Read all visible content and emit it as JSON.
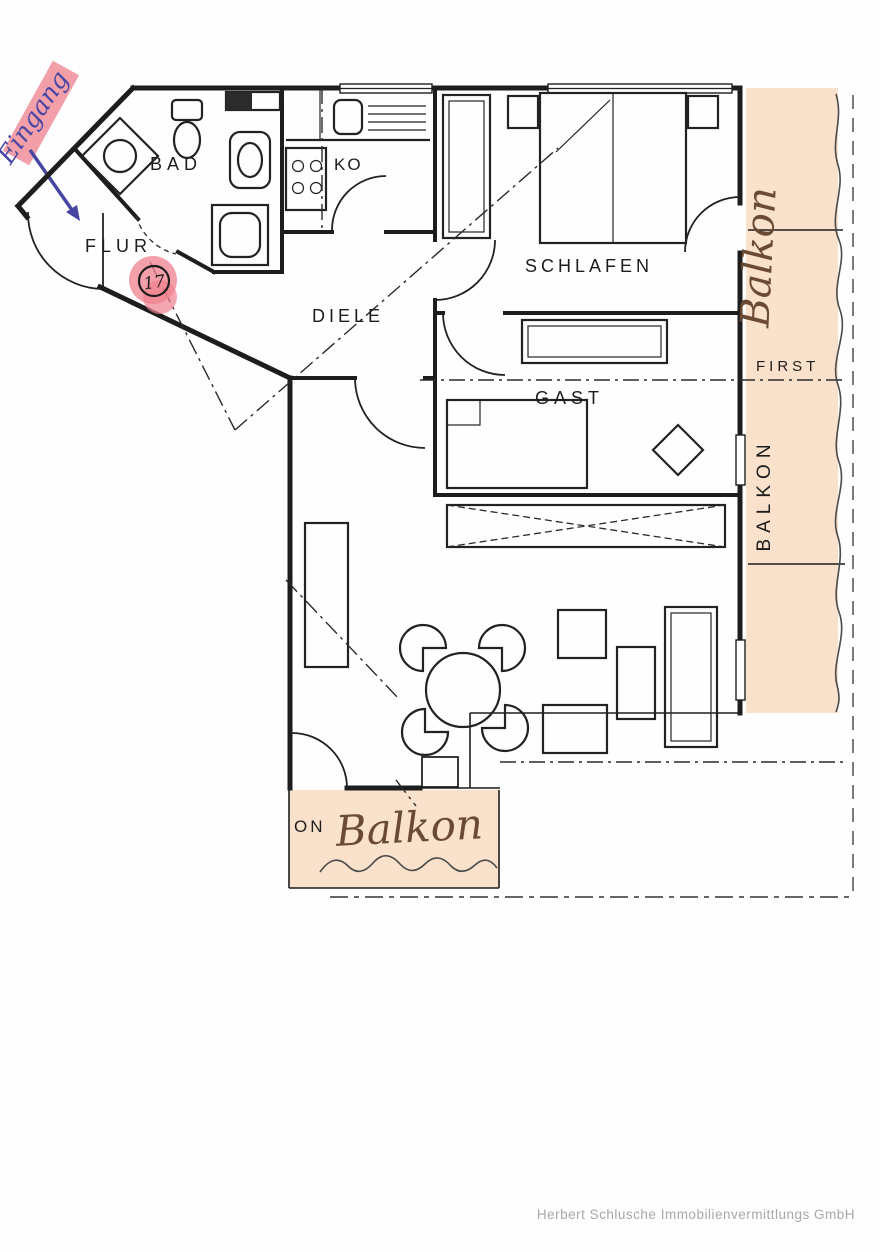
{
  "document": {
    "footer": "Herbert Schlusche Immobilienvermittlungs GmbH"
  },
  "annotations": {
    "entrance": "Eingang",
    "apartment_number": "17",
    "balcony_right_handwritten": "Balkon",
    "balcony_bottom_handwritten": "Balkon"
  },
  "rooms": {
    "bathroom": "BAD",
    "kitchen": "KO",
    "hall_entry": "FLUR",
    "hallway": "DIELE",
    "bedroom": "SCHLAFEN",
    "guest": "GAST"
  },
  "balcony": {
    "right_printed": "BALKON",
    "bottom_printed_partial": "ON",
    "ridge_label": "FIRST"
  },
  "colors": {
    "highlight_pink": "#f0808e",
    "highlight_peach": "#f8dcc2",
    "ink_blue": "#4646a2",
    "ink_brown": "#6b4a33",
    "line_black": "#1d1d1d",
    "footer_gray": "#a8a8a8"
  }
}
